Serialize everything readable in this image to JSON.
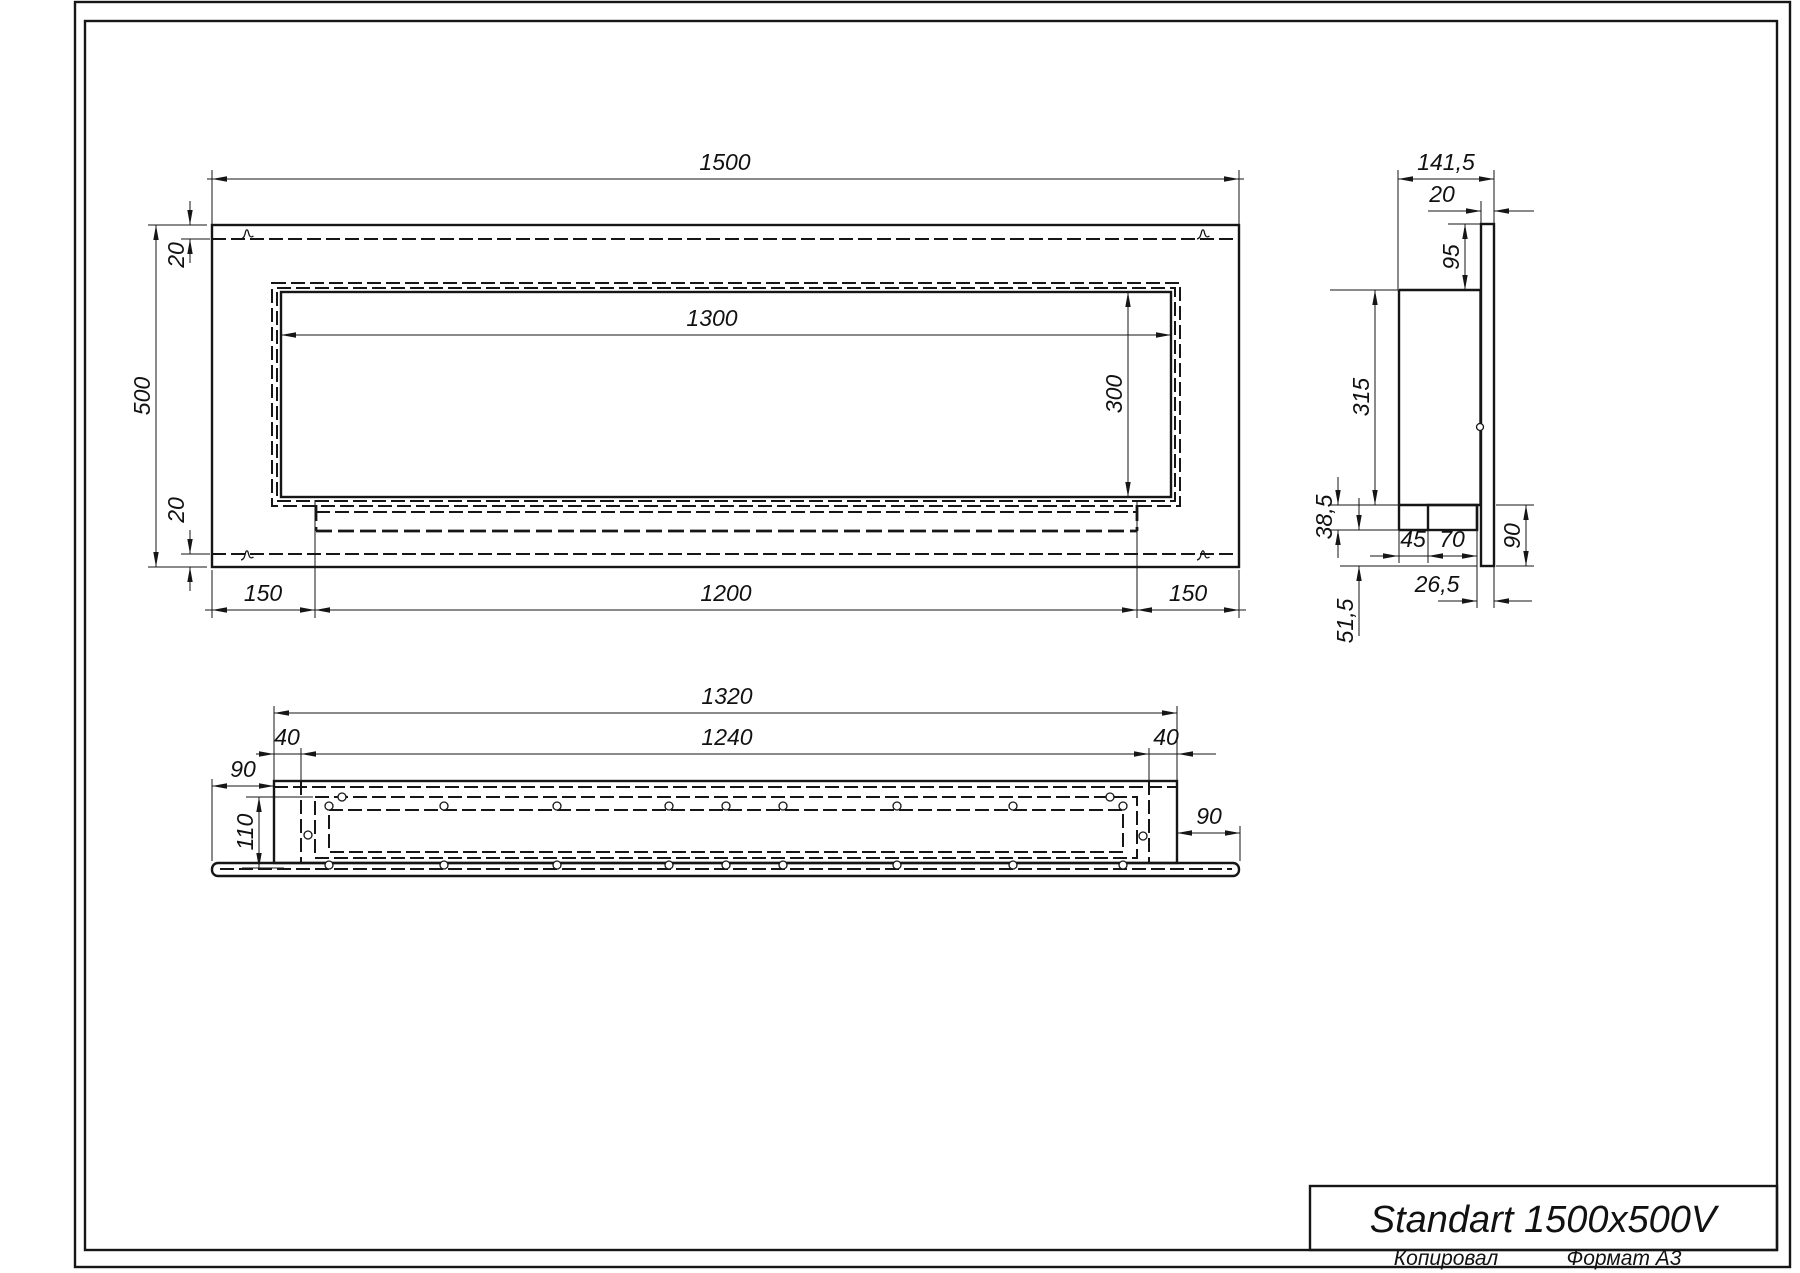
{
  "sheet": {
    "title": "Standart 1500x500V",
    "footer": {
      "copied_by": "Копировал",
      "format": "Формат А3"
    }
  },
  "front_view": {
    "dims": {
      "overall_width": "1500",
      "overall_height": "500",
      "top_flange": "20",
      "bottom_flange": "20",
      "opening_width": "1300",
      "opening_height": "300",
      "left_offset": "150",
      "inner_box_width": "1200",
      "right_offset": "150"
    }
  },
  "side_view": {
    "dims": {
      "overall_depth": "141,5",
      "front_plate": "20",
      "top_drop": "95",
      "body_height": "315",
      "step_height": "38,5",
      "burner_offset": "45",
      "burner_width": "70",
      "lower_plate_height": "90",
      "lip_depth": "26,5",
      "lip_height": "51,5"
    }
  },
  "bottom_view": {
    "dims": {
      "body_width": "1320",
      "opening_width": "1240",
      "left_wall": "40",
      "right_wall": "40",
      "left_flange": "90",
      "right_flange": "90",
      "depth": "110"
    }
  }
}
